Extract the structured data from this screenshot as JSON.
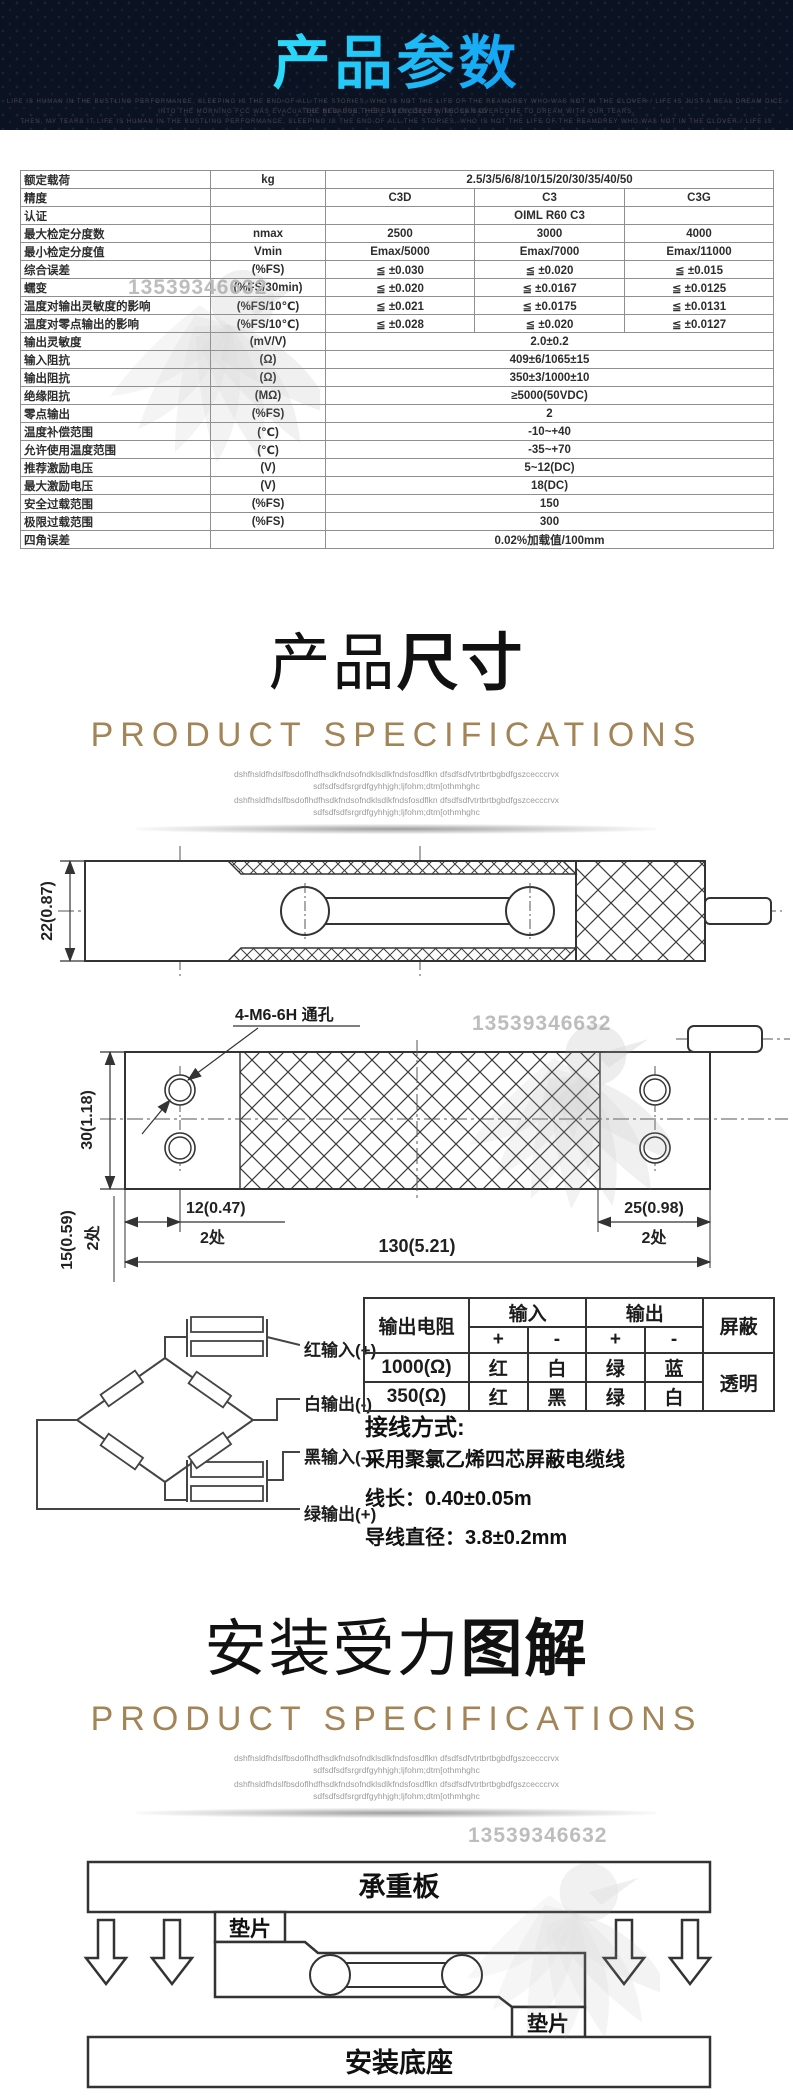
{
  "watermark_number": "13539346632",
  "header": {
    "title": "产品参数",
    "subtext": [
      "LIFE IS HUMAN IN THE BUSTLING PERFORMANCE, SLEEPING IS THE END OF ALL THE STORIES, WHO IS NOT THE LIFE OF THE REAMDREY WHO WAS NOT IN THE CLOVER / LIFE IS JUST A REAL DREAM DICE. THE NEW SUN, THE CAMENCDECYS, THOSE SAD",
      "INTO THE MORNING FCC WAS EVACUATED. BECAUSE THERE IS DIVISIVE WINE, CAN OVERCOME TO DREAM WITH OUR TEARS,",
      "THEN, MY TEARS IT LIFE IS HUMAN IN THE BUSTLING PERFORMANCE, SLEEPING IS THE END OF ALL THE STORIES, WHO IS NOT THE LIFE OF THE REAMDREY WHO WAS NOT IN THE CLOVER / LIFE IS"
    ]
  },
  "spec_table": {
    "rows": [
      {
        "label": "额定载荷",
        "unit": "kg",
        "value": "2.5/3/5/6/8/10/15/20/30/35/40/50"
      },
      {
        "label": "精度",
        "unit": "",
        "values": [
          "C3D",
          "C3",
          "C3G"
        ]
      },
      {
        "label": "认证",
        "unit": "",
        "values": [
          "",
          "OIML R60 C3",
          ""
        ]
      },
      {
        "label": "最大检定分度数",
        "unit": "nmax",
        "values": [
          "2500",
          "3000",
          "4000"
        ]
      },
      {
        "label": "最小检定分度值",
        "unit": "Vmin",
        "values": [
          "Emax/5000",
          "Emax/7000",
          "Emax/11000"
        ]
      },
      {
        "label": "综合误差",
        "unit": "(%FS)",
        "values": [
          "≦ ±0.030",
          "≦ ±0.020",
          "≦ ±0.015"
        ]
      },
      {
        "label": "蠕变",
        "unit": "(%FS/30min)",
        "values": [
          "≦ ±0.020",
          "≦ ±0.0167",
          "≦ ±0.0125"
        ]
      },
      {
        "label": "温度对输出灵敏度的影响",
        "unit": "(%FS/10℃)",
        "values": [
          "≦ ±0.021",
          "≦ ±0.0175",
          "≦ ±0.0131"
        ]
      },
      {
        "label": "温度对零点输出的影响",
        "unit": "(%FS/10℃)",
        "values": [
          "≦ ±0.028",
          "≦ ±0.020",
          "≦ ±0.0127"
        ]
      },
      {
        "label": "输出灵敏度",
        "unit": "(mV/V)",
        "value": "2.0±0.2"
      },
      {
        "label": "输入阻抗",
        "unit": "(Ω)",
        "value": "409±6/1065±15"
      },
      {
        "label": "输出阻抗",
        "unit": "(Ω)",
        "value": "350±3/1000±10"
      },
      {
        "label": "绝缘阻抗",
        "unit": "(MΩ)",
        "value": "≥5000(50VDC)"
      },
      {
        "label": "零点输出",
        "unit": "(%FS)",
        "value": "2"
      },
      {
        "label": "温度补偿范围",
        "unit": "(℃)",
        "value": "-10~+40"
      },
      {
        "label": "允许使用温度范围",
        "unit": "(℃)",
        "value": "-35~+70"
      },
      {
        "label": "推荐激励电压",
        "unit": "(V)",
        "value": "5~12(DC)"
      },
      {
        "label": "最大激励电压",
        "unit": "(V)",
        "value": "18(DC)"
      },
      {
        "label": "安全过载范围",
        "unit": "(%FS)",
        "value": "150"
      },
      {
        "label": "极限过载范围",
        "unit": "(%FS)",
        "value": "300"
      },
      {
        "label": "四角误差",
        "unit": "",
        "value": "0.02%加载值/100mm"
      }
    ]
  },
  "sections": [
    {
      "title_normal": "产品",
      "title_bold": "尺寸",
      "subtitle": "PRODUCT SPECIFICATIONS",
      "desc_line1": "dshfhsldfhdslfbsdoflhdfhsdkfndsofndklsdlkfndsfosdflkn dfsdfsdfvtrtbrtbgbdfgszcecccrvx",
      "desc_line2": "sdfsdfsdfsrgrdfgyhhjgh;ljfohm;dtm[othmhghc"
    },
    {
      "title_normal": "安装受力",
      "title_bold": "图解",
      "subtitle": "PRODUCT SPECIFICATIONS",
      "desc_line1": "dshfhsldfhdslfbsdoflhdfhsdkfndsofndklsdlkfndsfosdflkn dfsdfsdfvtrtbrtbgbdfgszcecccrvx",
      "desc_line2": "sdfsdfsdfsrgrdfgyhhjgh;ljfohm;dtm[othmhghc"
    }
  ],
  "drawing_side": {
    "dim_height": "22(0.87)"
  },
  "drawing_top": {
    "hole_label": "4-M6-6H 通孔",
    "dim_height": "30(1.18)",
    "dim_edge": "15(0.59)",
    "dim_left": "12(0.47)",
    "dim_total": "130(5.21)",
    "dim_right": "25(0.98)",
    "places": "2处"
  },
  "wiring": {
    "labels": {
      "red": "红输入(+)",
      "white": "白输出(-)",
      "black": "黑输入(-)",
      "green": "绿输出(+)"
    },
    "table": {
      "h_resistance": "输出电阻",
      "h_input": "输入",
      "h_output": "输出",
      "h_shield": "屏蔽",
      "plus": "+",
      "minus": "-",
      "rows": [
        {
          "resistance": "1000(Ω)",
          "cells": [
            "红",
            "白",
            "绿",
            "蓝"
          ]
        },
        {
          "resistance": "350(Ω)",
          "cells": [
            "红",
            "黑",
            "绿",
            "白"
          ]
        }
      ],
      "shield_value": "透明"
    },
    "method_title": "接线方式:",
    "method_lines": [
      "采用聚氯乙烯四芯屏蔽电缆线",
      "线长：0.40±0.05m",
      "导线直径：3.8±0.2mm"
    ]
  },
  "install": {
    "top_plate": "承重板",
    "spacer_left": "垫片",
    "spacer_right": "垫片",
    "base": "安装底座"
  }
}
